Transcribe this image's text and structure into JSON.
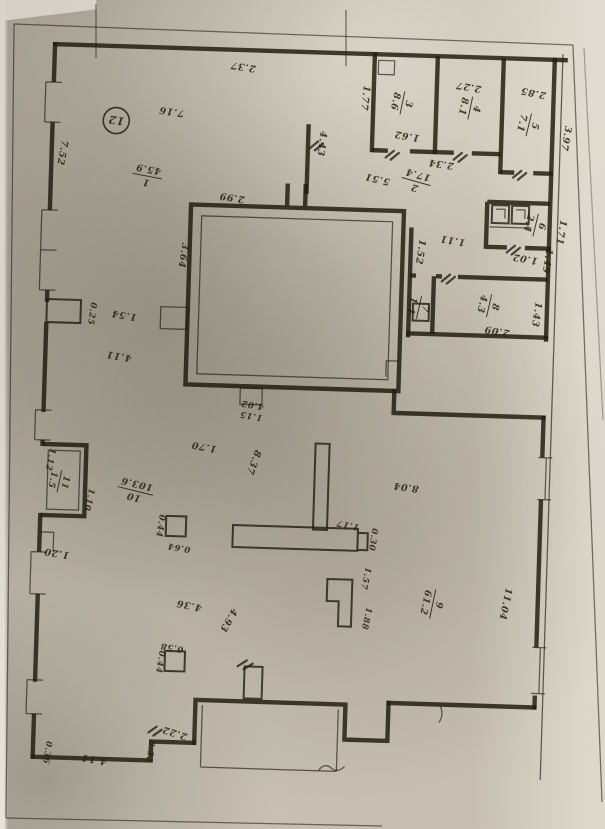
{
  "plan": {
    "ink": "#251e12",
    "paper": "#c9c2b5",
    "building_mark": "12",
    "rooms": [
      {
        "number": "1",
        "area": "45.9"
      },
      {
        "number": "2",
        "area": "17.4"
      },
      {
        "number": "3",
        "area": "8.6"
      },
      {
        "number": "4",
        "area": "8.1"
      },
      {
        "number": "5",
        "area": "7.1"
      },
      {
        "number": "6",
        "area": "2.4"
      },
      {
        "number": "7",
        "area": "1.1"
      },
      {
        "number": "8",
        "area": "4.3"
      },
      {
        "number": "9",
        "area": "61.2"
      },
      {
        "number": "10",
        "area": "103.6"
      },
      {
        "number": "11",
        "area": "1.5"
      }
    ],
    "labels": [
      {
        "t": "12",
        "x": 108,
        "y": 123,
        "r": 187,
        "circle": 13,
        "s": 11
      },
      {
        "t": "2.37",
        "x": 233,
        "y": 66,
        "r": 187
      },
      {
        "t": "7.16",
        "x": 163,
        "y": 113,
        "r": 187
      },
      {
        "t": "7.52",
        "x": 52,
        "y": 160,
        "r": 99
      },
      {
        "num": "1",
        "den": "45.9",
        "x": 140,
        "y": 182,
        "r": 189
      },
      {
        "t": "2.99",
        "x": 226,
        "y": 197,
        "r": 187
      },
      {
        "t": "3.64",
        "x": 176,
        "y": 259,
        "r": 97
      },
      {
        "t": "1.77",
        "x": 353,
        "y": 96,
        "r": 95
      },
      {
        "t": "4.43",
        "x": 311,
        "y": 143,
        "r": 95
      },
      {
        "t": "5.51",
        "x": 371,
        "y": 174,
        "r": 192
      },
      {
        "num": "2",
        "den": "17.4",
        "x": 409,
        "y": 179,
        "r": 194
      },
      {
        "t": "2.34",
        "x": 434,
        "y": 157,
        "r": 187
      },
      {
        "t": "1.62",
        "x": 399,
        "y": 130,
        "r": 188
      },
      {
        "t": "2.27",
        "x": 459,
        "y": 79,
        "r": 188
      },
      {
        "num": "3",
        "den": "8.6",
        "x": 394,
        "y": 100,
        "r": 100
      },
      {
        "num": "4",
        "den": "8.1",
        "x": 462,
        "y": 103,
        "r": 100
      },
      {
        "t": "2.85",
        "x": 524,
        "y": 83,
        "r": 190
      },
      {
        "t": "3.97",
        "x": 555,
        "y": 130,
        "r": 98
      },
      {
        "num": "5",
        "den": "7.1",
        "x": 521,
        "y": 118,
        "r": 102
      },
      {
        "num": "6",
        "den": "2.4",
        "x": 531,
        "y": 218,
        "r": 102
      },
      {
        "t": "1.71",
        "x": 553,
        "y": 224,
        "r": 98
      },
      {
        "t": "1.02",
        "x": 521,
        "y": 249,
        "r": 188
      },
      {
        "t": "1.11",
        "x": 448,
        "y": 233,
        "r": 188
      },
      {
        "t": "1.52",
        "x": 413,
        "y": 248,
        "r": 97
      },
      {
        "t": "1.49",
        "x": 540,
        "y": 253,
        "r": 97
      },
      {
        "t": "1.43",
        "x": 531,
        "y": 307,
        "r": 97
      },
      {
        "t": "2.09",
        "x": 495,
        "y": 322,
        "r": 188
      },
      {
        "num": "8",
        "den": "4.3",
        "x": 487,
        "y": 300,
        "r": 101
      },
      {
        "num": "7",
        "den": "1.1",
        "x": 417,
        "y": 304,
        "r": 101
      },
      {
        "t": "1.54",
        "x": 122,
        "y": 318,
        "r": 188
      },
      {
        "t": "0.25",
        "x": 87,
        "y": 320,
        "r": 97,
        "s": 8.5
      },
      {
        "t": "4.11",
        "x": 118,
        "y": 359,
        "r": 188
      },
      {
        "t": "4.02",
        "x": 253,
        "y": 404,
        "r": 188,
        "s": 8.5
      },
      {
        "t": "1.15",
        "x": 252,
        "y": 415,
        "r": 188,
        "s": 8.5
      },
      {
        "t": "1.70",
        "x": 206,
        "y": 447,
        "r": 189
      },
      {
        "t": "8.37",
        "x": 253,
        "y": 463,
        "r": 108
      },
      {
        "t": "8.04",
        "x": 409,
        "y": 481,
        "r": 186
      },
      {
        "num": "10",
        "den": "103.6",
        "x": 138,
        "y": 497,
        "r": 192
      },
      {
        "t": "0.44",
        "x": 162,
        "y": 530,
        "r": 97,
        "s": 8.5
      },
      {
        "t": "0.64",
        "x": 184,
        "y": 549,
        "r": 188,
        "s": 8.5
      },
      {
        "t": "1.17",
        "x": 352,
        "y": 521,
        "r": 190,
        "s": 8.5
      },
      {
        "t": "0.30",
        "x": 375,
        "y": 537,
        "r": 97,
        "s": 8.5
      },
      {
        "t": "1.57",
        "x": 369,
        "y": 576,
        "r": 100,
        "s": 8.5
      },
      {
        "t": "1.88",
        "x": 371,
        "y": 616,
        "r": 100,
        "s": 8.5
      },
      {
        "t": "4.36",
        "x": 196,
        "y": 606,
        "r": 190
      },
      {
        "t": "4.93",
        "x": 233,
        "y": 621,
        "r": 118
      },
      {
        "t": "0.58",
        "x": 180,
        "y": 649,
        "r": 188,
        "s": 8.5
      },
      {
        "t": "0.44",
        "x": 166,
        "y": 666,
        "r": 97,
        "s": 8.5
      },
      {
        "num": "9",
        "den": "61.2",
        "x": 440,
        "y": 600,
        "r": 100
      },
      {
        "t": "11.04",
        "x": 509,
        "y": 597,
        "r": 100
      },
      {
        "t": "1.12",
        "x": 50,
        "y": 467,
        "r": 100,
        "s": 8.5
      },
      {
        "num": "11",
        "den": "1.5",
        "x": 63,
        "y": 489,
        "r": 100,
        "s": 9
      },
      {
        "t": "1.10",
        "x": 90,
        "y": 506,
        "r": 100,
        "s": 8.5
      },
      {
        "t": "1.20",
        "x": 62,
        "y": 558,
        "r": 188
      },
      {
        "t": "2.22",
        "x": 186,
        "y": 734,
        "r": 196
      },
      {
        "t": "0.32",
        "x": 159,
        "y": 756,
        "r": 97,
        "s": 8.5
      },
      {
        "t": "4.14",
        "x": 106,
        "y": 763,
        "r": 188
      },
      {
        "t": "0.36",
        "x": 56,
        "y": 760,
        "r": 97,
        "s": 8.5
      }
    ]
  }
}
